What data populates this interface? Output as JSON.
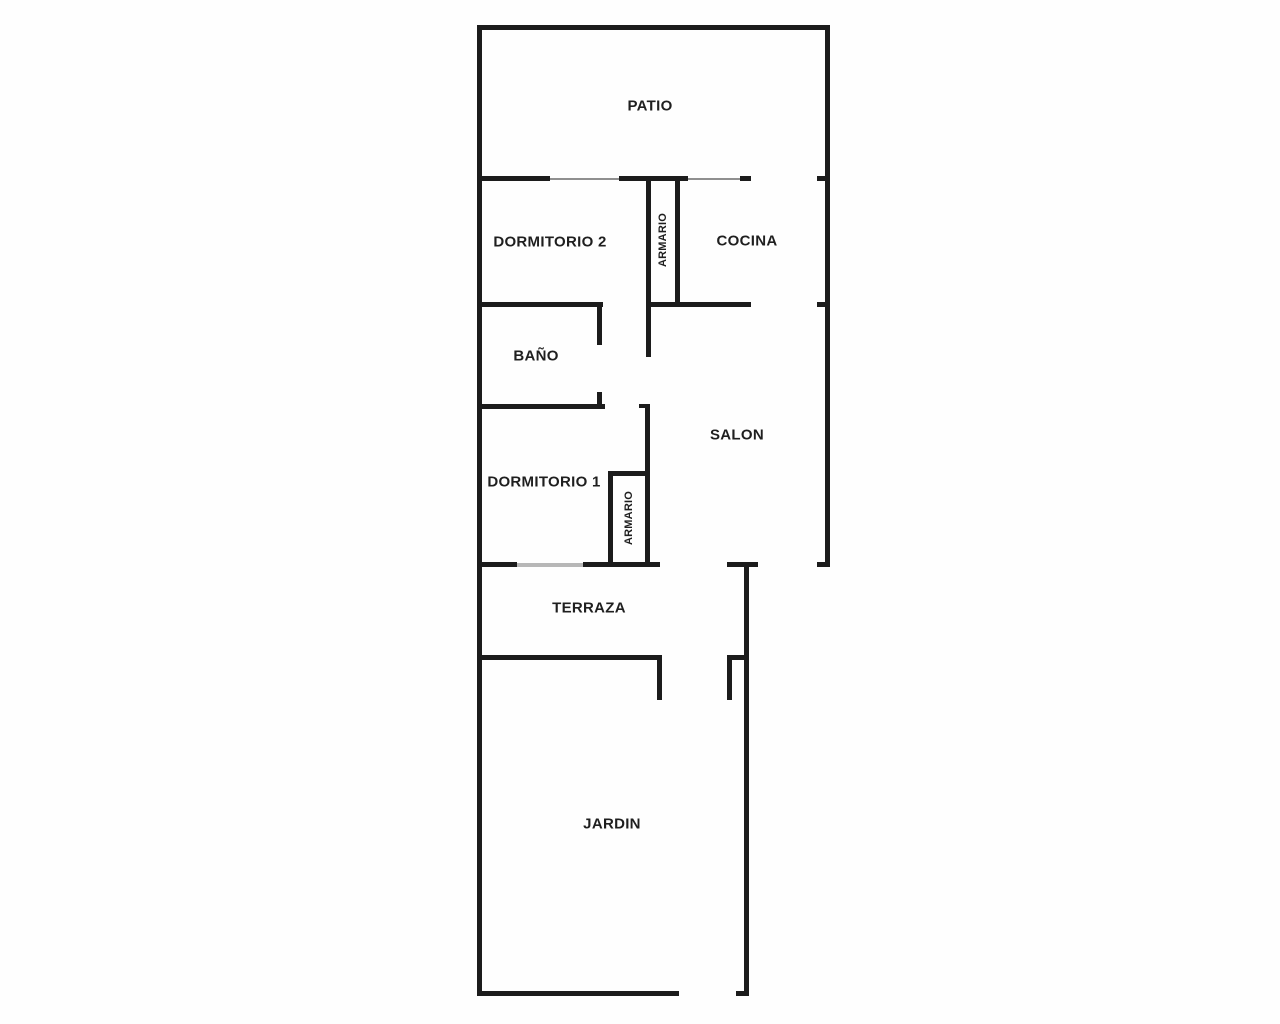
{
  "floorplan": {
    "title": "floor plan",
    "rooms": [
      {
        "id": "patio",
        "label": "PATIO"
      },
      {
        "id": "dormitorio2",
        "label": "DORMITORIO 2"
      },
      {
        "id": "armario-top",
        "label": "ARMARIO"
      },
      {
        "id": "cocina",
        "label": "COCINA"
      },
      {
        "id": "bano",
        "label": "BAÑO"
      },
      {
        "id": "salon",
        "label": "SALON"
      },
      {
        "id": "dormitorio1",
        "label": "DORMITORIO 1"
      },
      {
        "id": "armario-bottom",
        "label": "ARMARIO"
      },
      {
        "id": "terraza",
        "label": "TERRAZA"
      },
      {
        "id": "jardin",
        "label": "JARDIN"
      }
    ],
    "colors": {
      "wall": "#1c1c1c",
      "door_line": "#8f8f8f",
      "threshold_line": "#b7b7b7",
      "background": "#fefefe",
      "label_text": "#1f1f1f"
    }
  }
}
